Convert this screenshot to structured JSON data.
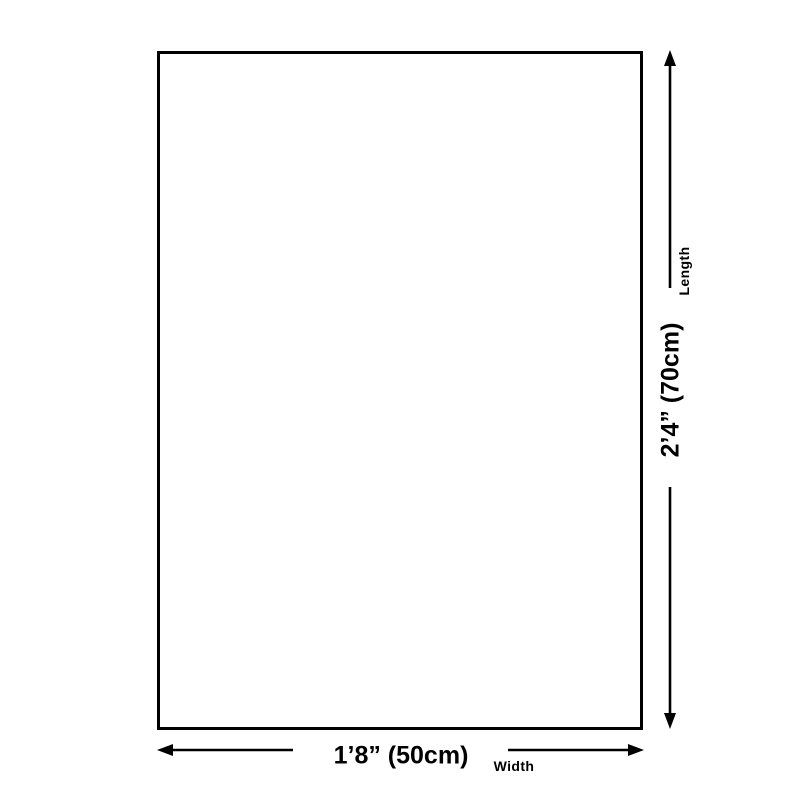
{
  "canvas": {
    "background": "#ffffff",
    "line_color": "#000000",
    "text_color": "#000000"
  },
  "product_box": {
    "fill": "#ffffff",
    "border_color": "#000000"
  },
  "dimensions": {
    "length": {
      "value": "2’4” (70cm)",
      "label": "Length"
    },
    "width": {
      "value": "1’8” (50cm)",
      "label": "Width"
    }
  }
}
